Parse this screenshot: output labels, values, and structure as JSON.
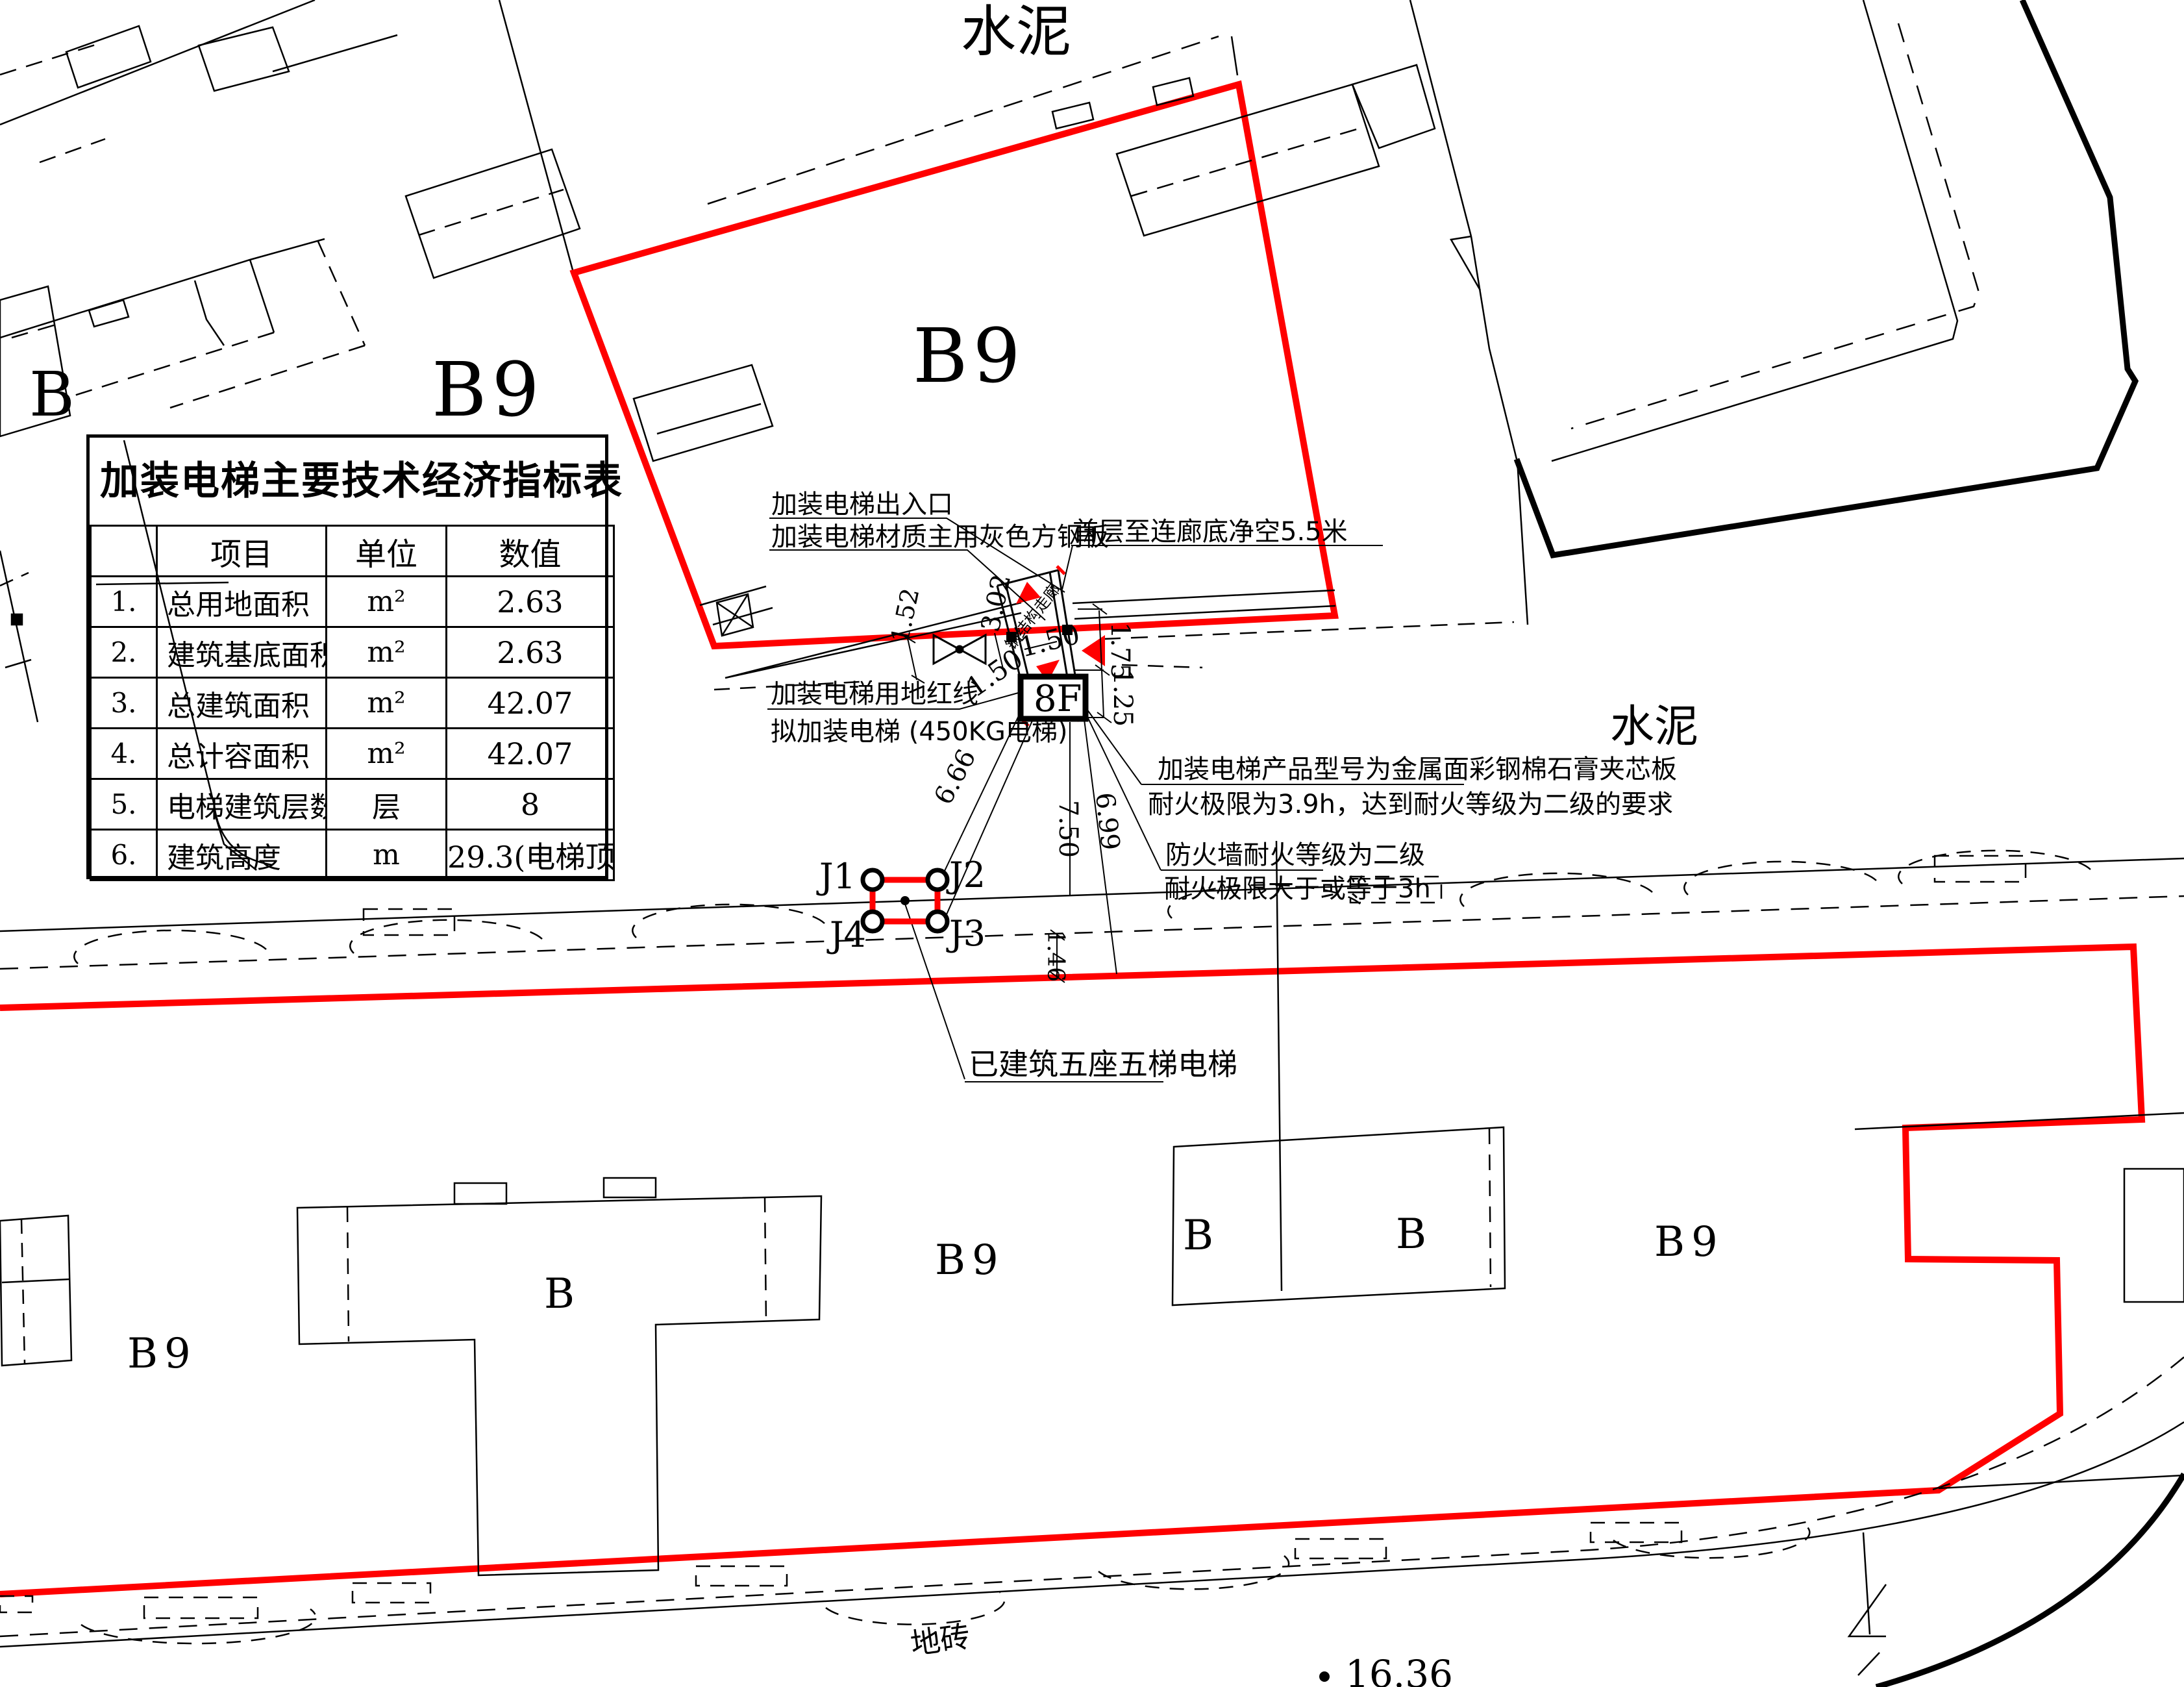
{
  "indicator_table": {
    "title": "加装电梯主要技术经济指标表",
    "headers": {
      "item": "项目",
      "unit": "单位",
      "value": "数值"
    },
    "rows": [
      {
        "no": "1.",
        "item": "总用地面积",
        "unit": "m²",
        "value": "2.63"
      },
      {
        "no": "2.",
        "item": "建筑基底面积",
        "unit": "m²",
        "value": "2.63"
      },
      {
        "no": "3.",
        "item": "总建筑面积",
        "unit": "m²",
        "value": "42.07"
      },
      {
        "no": "4.",
        "item": "总计容面积",
        "unit": "m²",
        "value": "42.07"
      },
      {
        "no": "5.",
        "item": "电梯建筑层数",
        "unit": "层",
        "value": "8"
      },
      {
        "no": "6.",
        "item": "建筑高度",
        "unit": "m",
        "value": "29.3(电梯顶)"
      }
    ]
  },
  "site_labels": {
    "cement_top": "水泥",
    "cement_right": "水泥",
    "floor_tile": "地砖",
    "b_topleft": "B",
    "b9_topleft": "B9",
    "b9_topcenter": "B9",
    "b9_bottomleft": "B9",
    "b_t_building": "B",
    "b9_bottom_center": "B9",
    "b_bottom_1": "B",
    "b_bottom_2": "B",
    "b9_bottom_right": "B9",
    "elevator_core": "8F",
    "corridor": "钢结构走廊",
    "spot_elevation": "16.36"
  },
  "annotations": {
    "entrance": "加装电梯出入口",
    "material": "加装电梯材质主用灰色方钢板",
    "clearance": "首层至连廊底净空5.5米",
    "red_line": "加装电梯用地红线",
    "proposed": "拟加装电梯 (450KG电梯)",
    "product_line1": "加装电梯产品型号为金属面彩钢棉石膏夹芯板",
    "product_line2": "耐火极限为3.9h，达到耐火等级为二级的要求",
    "firewall_line1": "防火墙耐火等级为二级",
    "firewall_line2": "耐火极限大于或等于3h",
    "existing": "已建筑五座五梯电梯"
  },
  "junction_points": {
    "j1": "J1",
    "j2": "J2",
    "j3": "J3",
    "j4": "J4"
  },
  "dimensions": {
    "d152": "1.52",
    "d302": "3.02",
    "d150a": "1.50",
    "d150b": "1.50",
    "d175": "1.75",
    "d125": "1.25",
    "d666": "6.66",
    "d750": "7.50",
    "d699": "6.99",
    "d146": "1.46"
  },
  "colors": {
    "boundary_red": "#ff0000",
    "label_red": "#ff4444",
    "line_black": "#000000"
  }
}
